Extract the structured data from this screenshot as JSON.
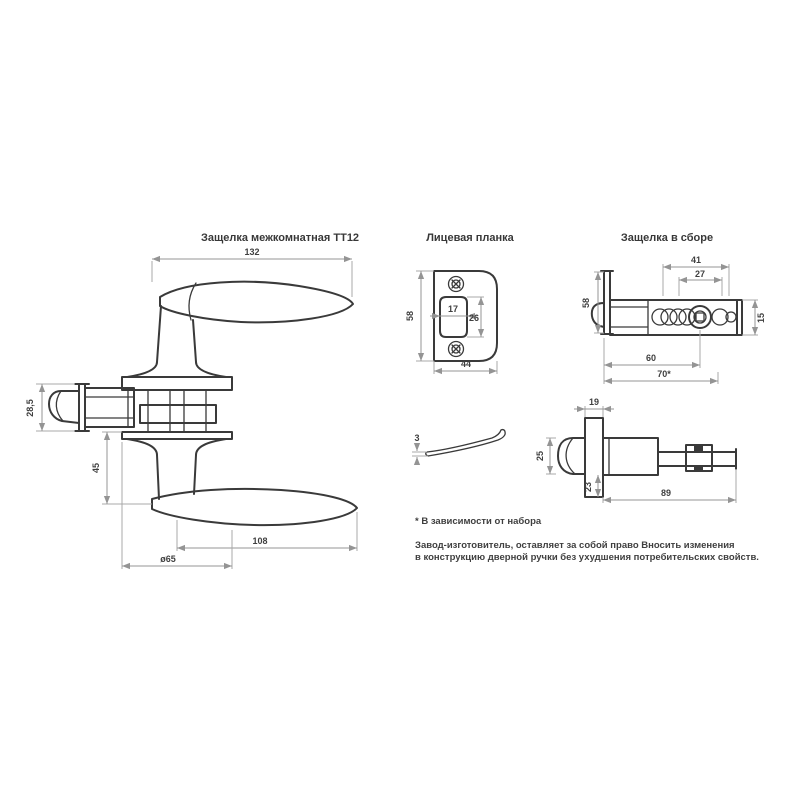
{
  "titles": {
    "handle_view": "Защелка межкомнатная ТТ12",
    "faceplate_view": "Лицевая планка",
    "latch_view": "Защелка в сборе"
  },
  "dims": {
    "handle": {
      "overall_length": "132",
      "latch_height": "28,5",
      "neck_offset": "45",
      "lever_length": "108",
      "rose_diameter": "ø65"
    },
    "faceplate": {
      "height": "58",
      "width": "44",
      "opening_width": "17",
      "opening_height": "26",
      "thickness": "3"
    },
    "latch_side": {
      "hub_section": "41",
      "spindle_section": "27",
      "body_height": "15",
      "plate_height": "58",
      "backset": "60",
      "backset_alt": "70*"
    },
    "latch_top": {
      "plate_edge": "19",
      "bolt_width": "25",
      "case_height": "23",
      "overall_length": "89"
    }
  },
  "notes": {
    "asterisk_note": "* В зависимости от набора",
    "disclaimer_line1": "Завод-изготовитель, оставляет за собой право Вносить изменения",
    "disclaimer_line2": "в конструкцию дверной ручки без ухудшения потребительских свойств."
  },
  "colors": {
    "line": "#3a3a3a",
    "dimension": "#949494",
    "text": "#3f3f3f"
  }
}
